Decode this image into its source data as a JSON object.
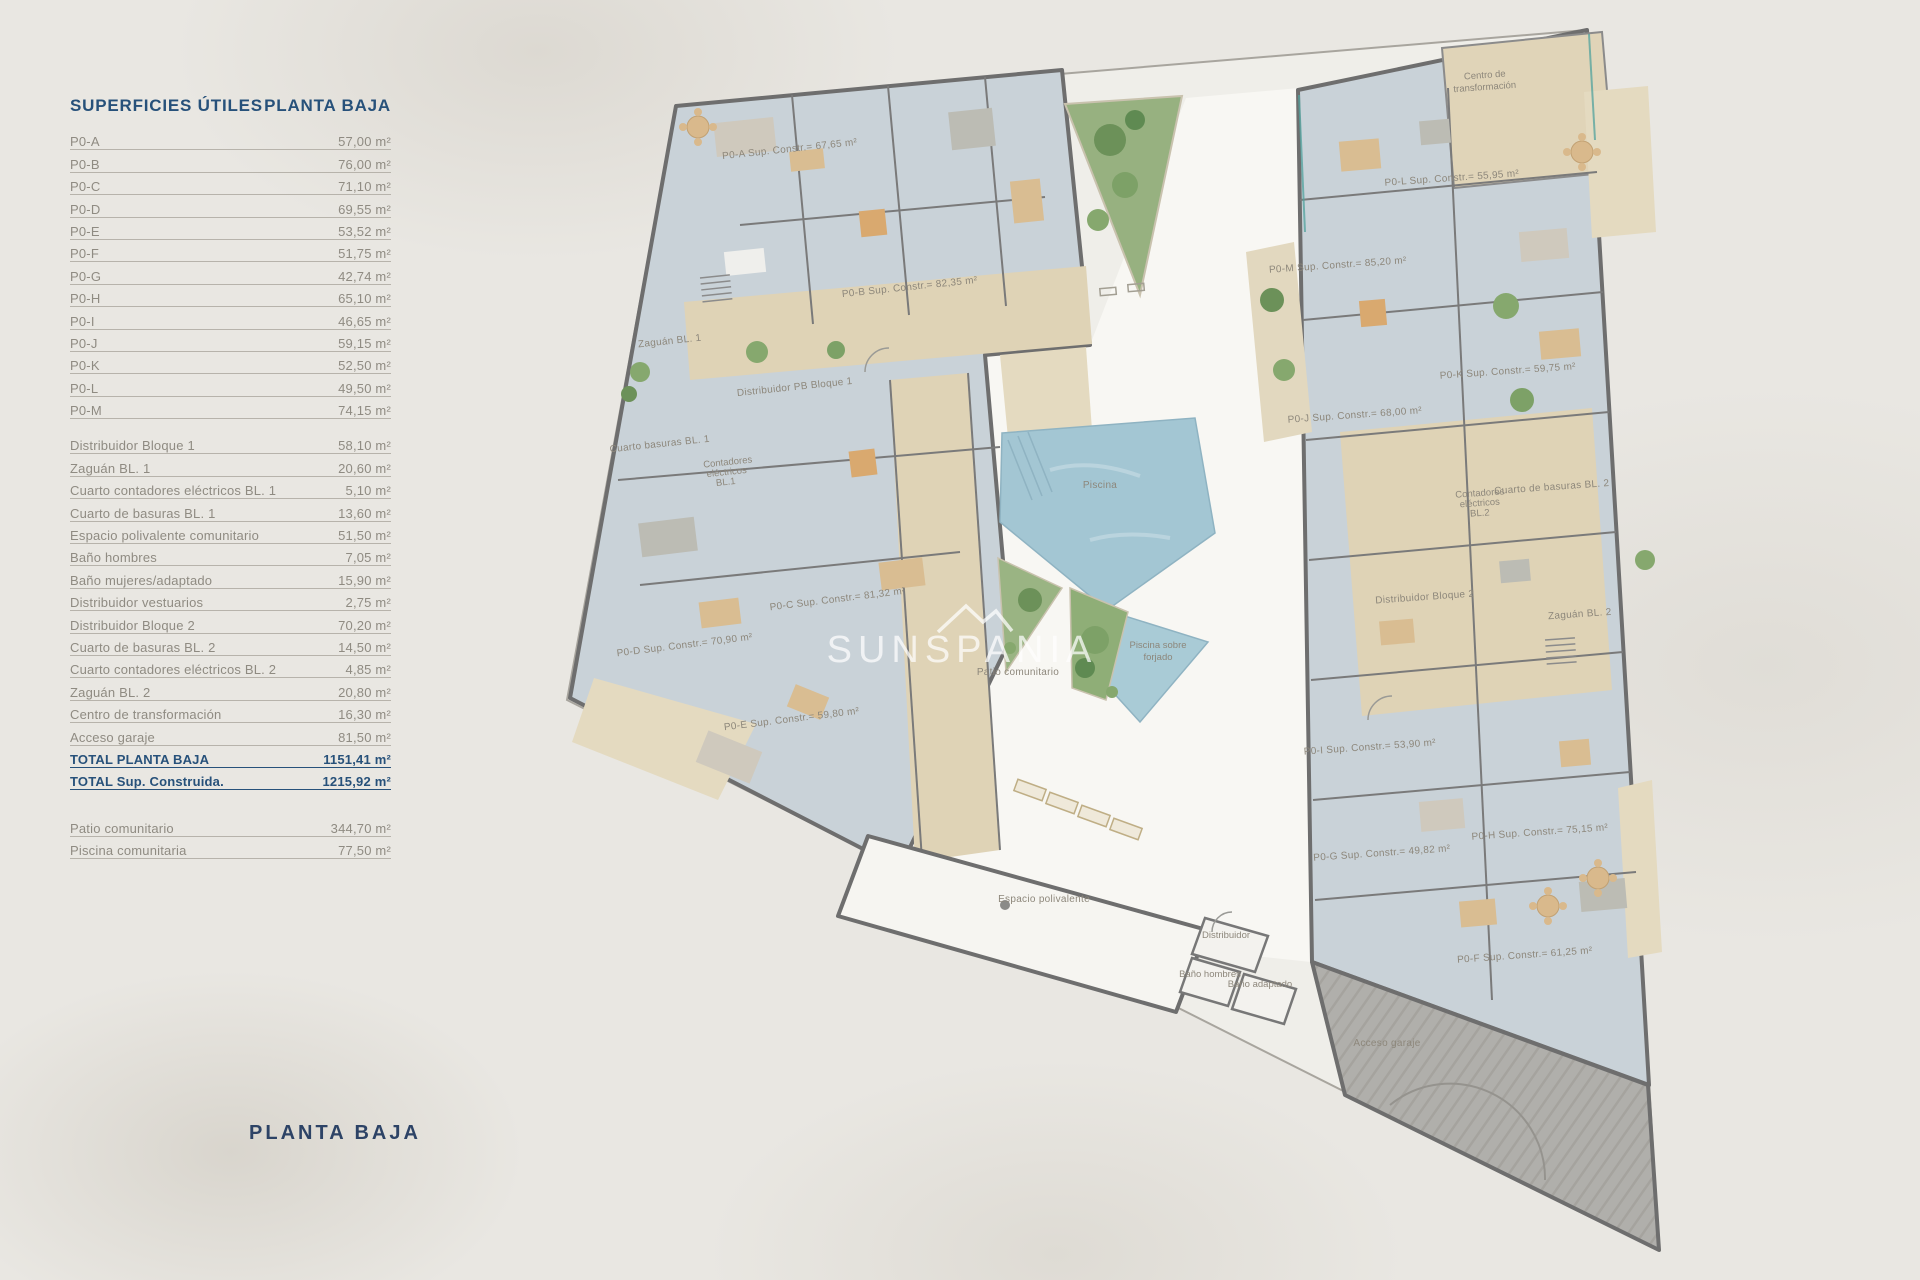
{
  "table": {
    "title": "SUPERFICIES ÚTILES",
    "subtitle": "PLANTA BAJA",
    "units": [
      {
        "label": "P0-A",
        "value": "57,00 m²"
      },
      {
        "label": "P0-B",
        "value": "76,00 m²"
      },
      {
        "label": "P0-C",
        "value": "71,10 m²"
      },
      {
        "label": "P0-D",
        "value": "69,55 m²"
      },
      {
        "label": "P0-E",
        "value": "53,52 m²"
      },
      {
        "label": "P0-F",
        "value": "51,75 m²"
      },
      {
        "label": "P0-G",
        "value": "42,74 m²"
      },
      {
        "label": "P0-H",
        "value": "65,10 m²"
      },
      {
        "label": "P0-I",
        "value": "46,65 m²"
      },
      {
        "label": "P0-J",
        "value": "59,15 m²"
      },
      {
        "label": "P0-K",
        "value": "52,50 m²"
      },
      {
        "label": "P0-L",
        "value": "49,50 m²"
      },
      {
        "label": "P0-M",
        "value": "74,15 m²"
      }
    ],
    "commons": [
      {
        "label": "Distribuidor Bloque 1",
        "value": "58,10 m²"
      },
      {
        "label": "Zaguán BL. 1",
        "value": "20,60 m²"
      },
      {
        "label": "Cuarto contadores eléctricos BL. 1",
        "value": "5,10 m²"
      },
      {
        "label": "Cuarto de basuras BL. 1",
        "value": "13,60 m²"
      },
      {
        "label": "Espacio polivalente comunitario",
        "value": "51,50 m²"
      },
      {
        "label": "Baño hombres",
        "value": "7,05 m²"
      },
      {
        "label": "Baño mujeres/adaptado",
        "value": "15,90 m²"
      },
      {
        "label": "Distribuidor vestuarios",
        "value": "2,75 m²"
      },
      {
        "label": "Distribuidor Bloque 2",
        "value": "70,20 m²"
      },
      {
        "label": "Cuarto de basuras BL. 2",
        "value": "14,50 m²"
      },
      {
        "label": "Cuarto contadores eléctricos BL. 2",
        "value": "4,85 m²"
      },
      {
        "label": "Zaguán BL. 2",
        "value": "20,80 m²"
      },
      {
        "label": "Centro de transformación",
        "value": "16,30 m²"
      },
      {
        "label": "Acceso garaje",
        "value": "81,50 m²"
      }
    ],
    "totals": [
      {
        "label": "TOTAL PLANTA BAJA",
        "value": "1151,41 m²"
      },
      {
        "label": "TOTAL Sup. Construida.",
        "value": "1215,92 m²"
      }
    ],
    "outdoor": [
      {
        "label": "Patio comunitario",
        "value": "344,70 m²"
      },
      {
        "label": "Piscina comunitaria",
        "value": "77,50 m²"
      }
    ]
  },
  "footer_title": "PLANTA BAJA",
  "watermark": "SUNSPANIA",
  "plan": {
    "units": {
      "a": "P0-A Sup. Constr.= 67,65 m²",
      "b": "P0-B Sup. Constr.= 82,35 m²",
      "c": "P0-C Sup. Constr.= 81,32 m²",
      "d": "P0-D Sup. Constr.= 70,90 m²",
      "e": "P0-E Sup. Constr.= 59,80 m²",
      "f": "P0-F Sup. Constr.= 61,25 m²",
      "g": "P0-G Sup. Constr.= 49,82 m²",
      "h": "P0-H Sup. Constr.= 75,15 m²",
      "i": "P0-I Sup. Constr.= 53,90 m²",
      "j": "P0-J Sup. Constr.= 68,00 m²",
      "k": "P0-K Sup. Constr.= 59,75 m²",
      "l": "P0-L Sup. Constr.= 55,95 m²",
      "m": "P0-M Sup. Constr.= 85,20 m²"
    },
    "rooms": {
      "zaguan1": "Zaguán BL. 1",
      "distribuidor1": "Distribuidor PB Bloque 1",
      "basuras1": "Cuarto basuras BL. 1",
      "contadores1": [
        "Contadores",
        "eléctricos",
        "BL.1"
      ],
      "piscina": "Piscina",
      "piscina_forjado": [
        "Piscina sobre",
        "forjado"
      ],
      "patio": "Patio comunitario",
      "espacio": "Espacio polivalente",
      "distribuidor": "Distribuidor",
      "bano_hombres": "Baño hombres",
      "bano_adaptado": "Baño adaptado",
      "garaje": "Acceso garaje",
      "distribuidor2": "Distribuidor Bloque 2",
      "zaguan2": "Zaguán BL. 2",
      "basuras2": "Cuarto de basuras BL. 2",
      "contadores2": [
        "Contadores",
        "eléctricos",
        "BL.2"
      ],
      "centro": [
        "Centro de",
        "transformación"
      ]
    }
  },
  "colors": {
    "navy": "#27517a",
    "muted": "#8f8b82",
    "tile": "#c9d2d8",
    "beige": "#dfd3b6",
    "pool": "#a3c6d3",
    "green": "#97b180",
    "wall": "#6e6e6e",
    "patio": "#f8f7f3",
    "garage": "#b0afab",
    "background": "#e9e7e2"
  }
}
